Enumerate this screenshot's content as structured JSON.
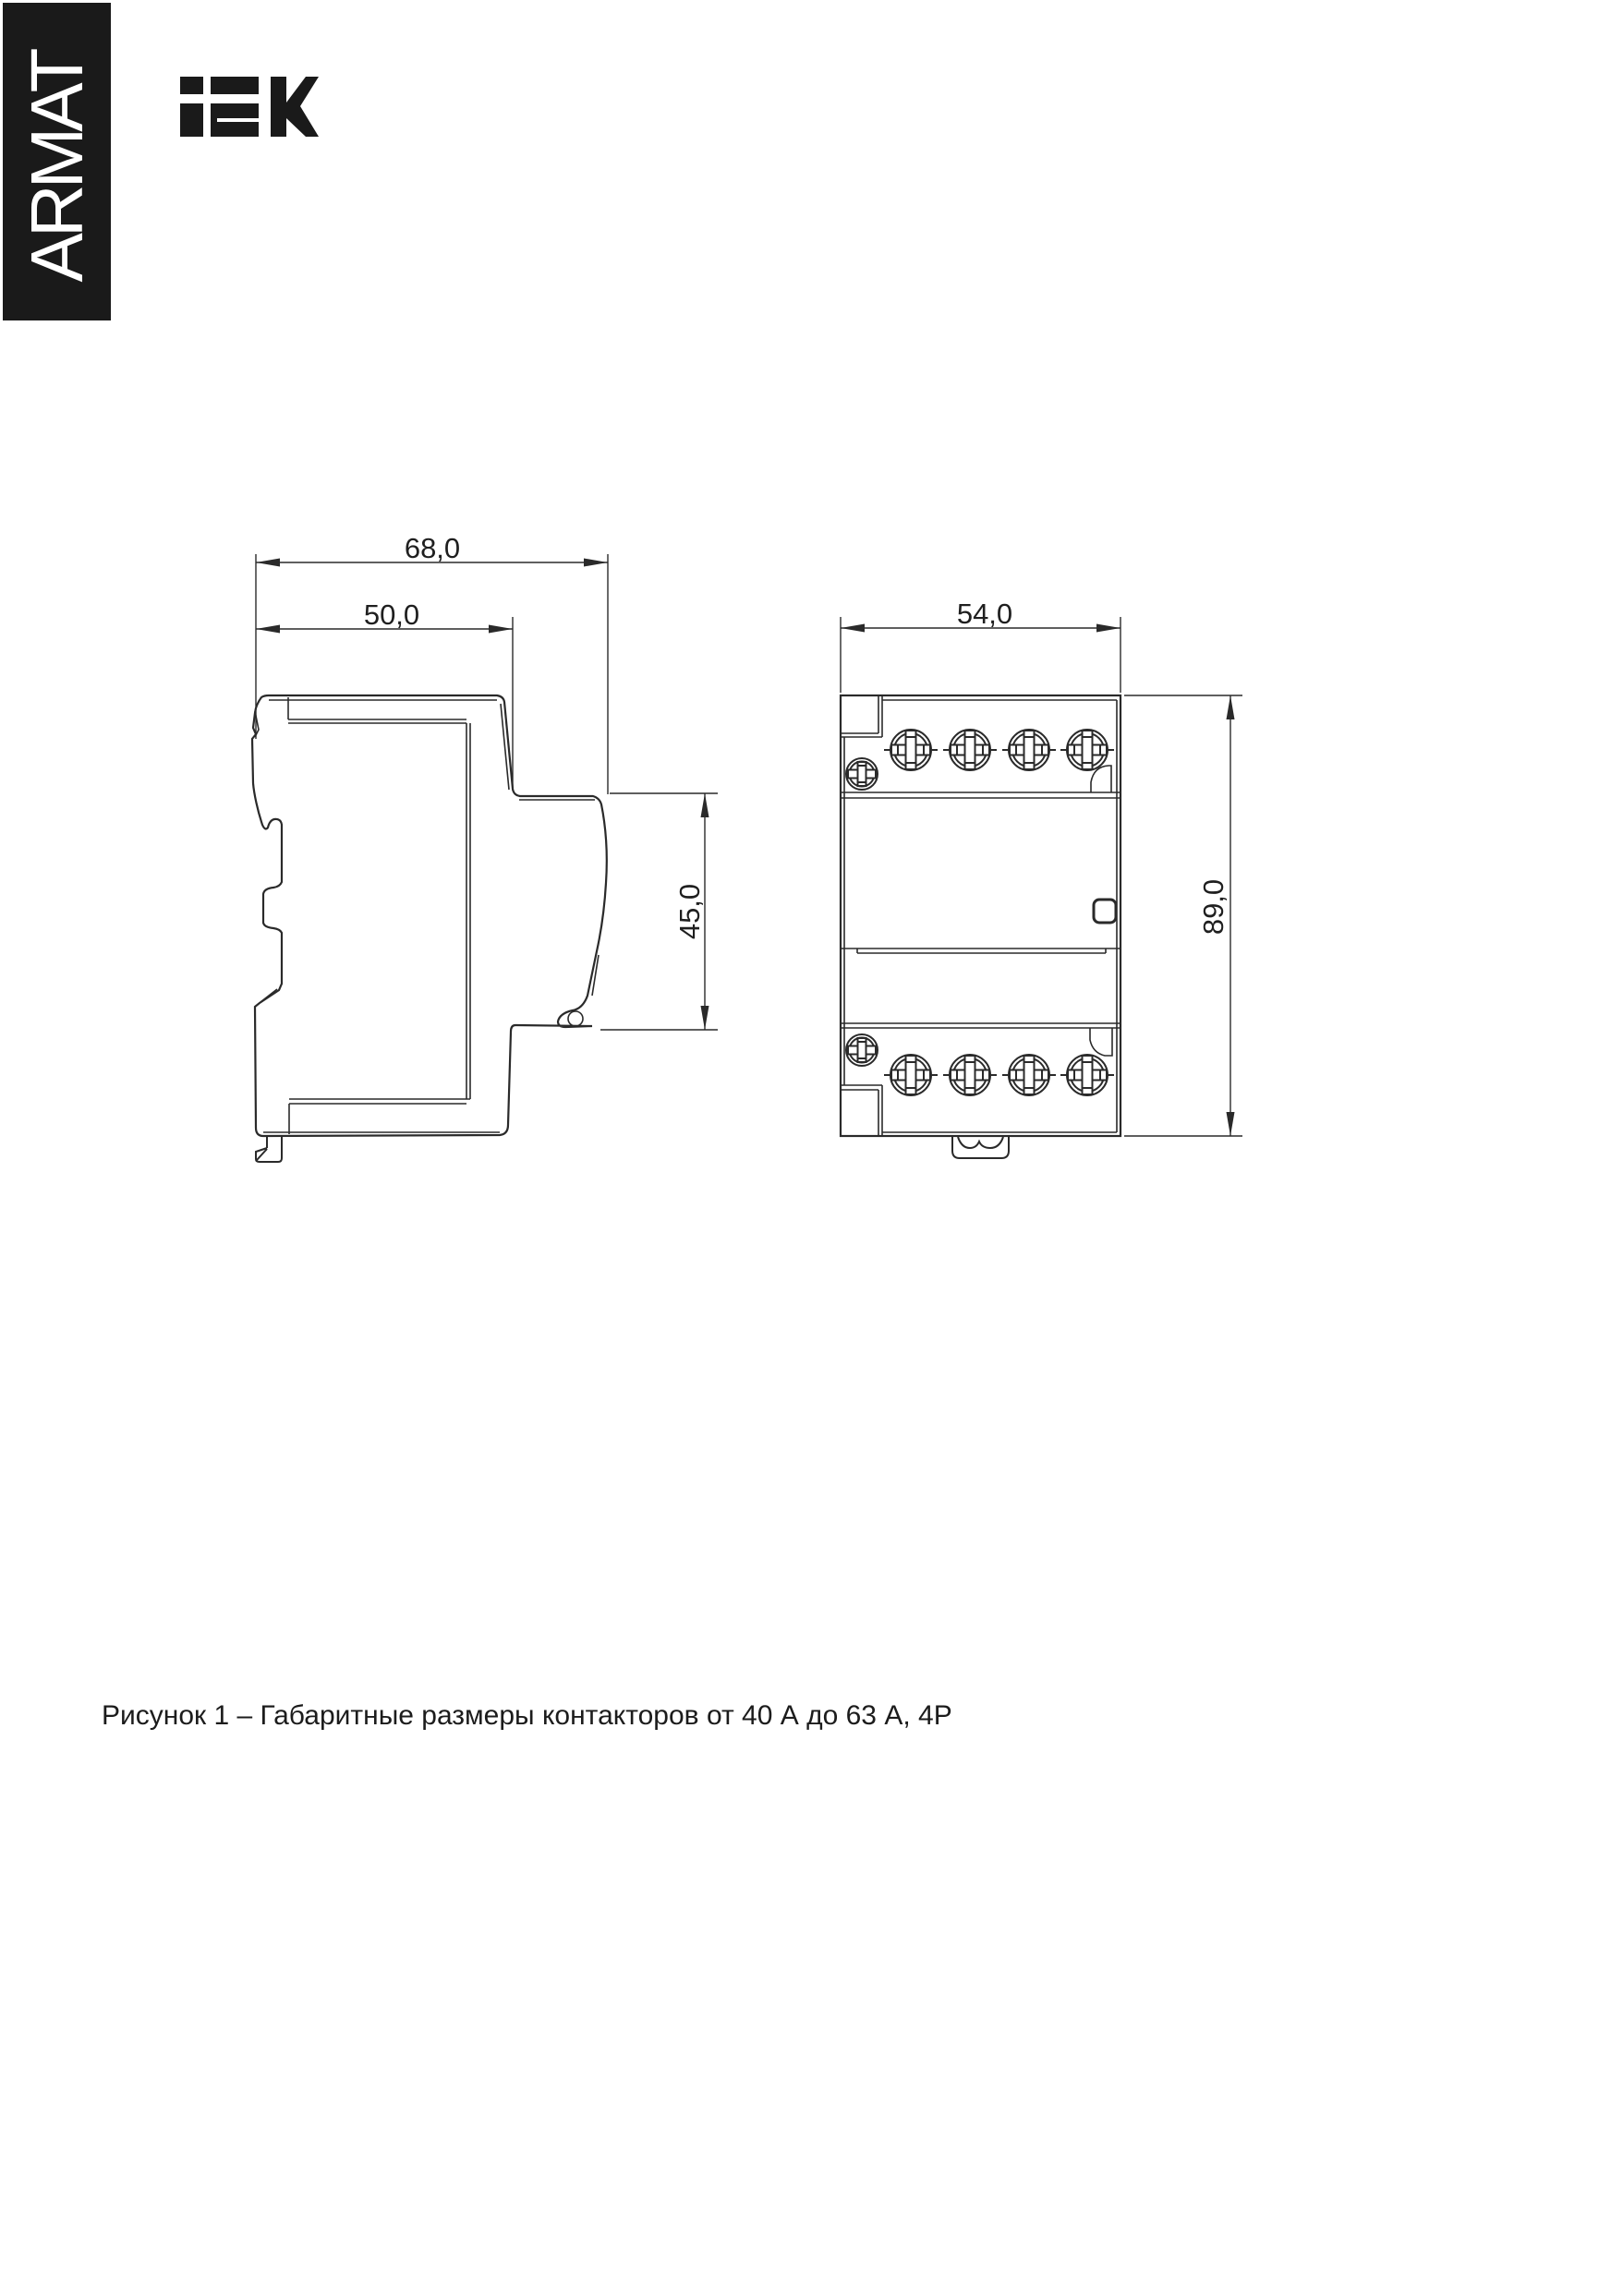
{
  "banner": {
    "label": "ARMAT",
    "bg_color": "#1a1a1a",
    "fg_color": "#ffffff"
  },
  "brand": {
    "logo": "iEK",
    "color": "#1a1a1a"
  },
  "figure": {
    "caption": "Рисунок 1 – Габаритные размеры контакторов от 40 А до 63 А, 4Р",
    "line_color": "#2a2a2a",
    "side_view": {
      "name": "side-view",
      "dim_overall_width": "68,0",
      "dim_body_width": "50,0",
      "dim_din_depth": "45,0"
    },
    "front_view": {
      "name": "front-view",
      "dim_width": "54,0",
      "dim_height": "89,0"
    }
  }
}
